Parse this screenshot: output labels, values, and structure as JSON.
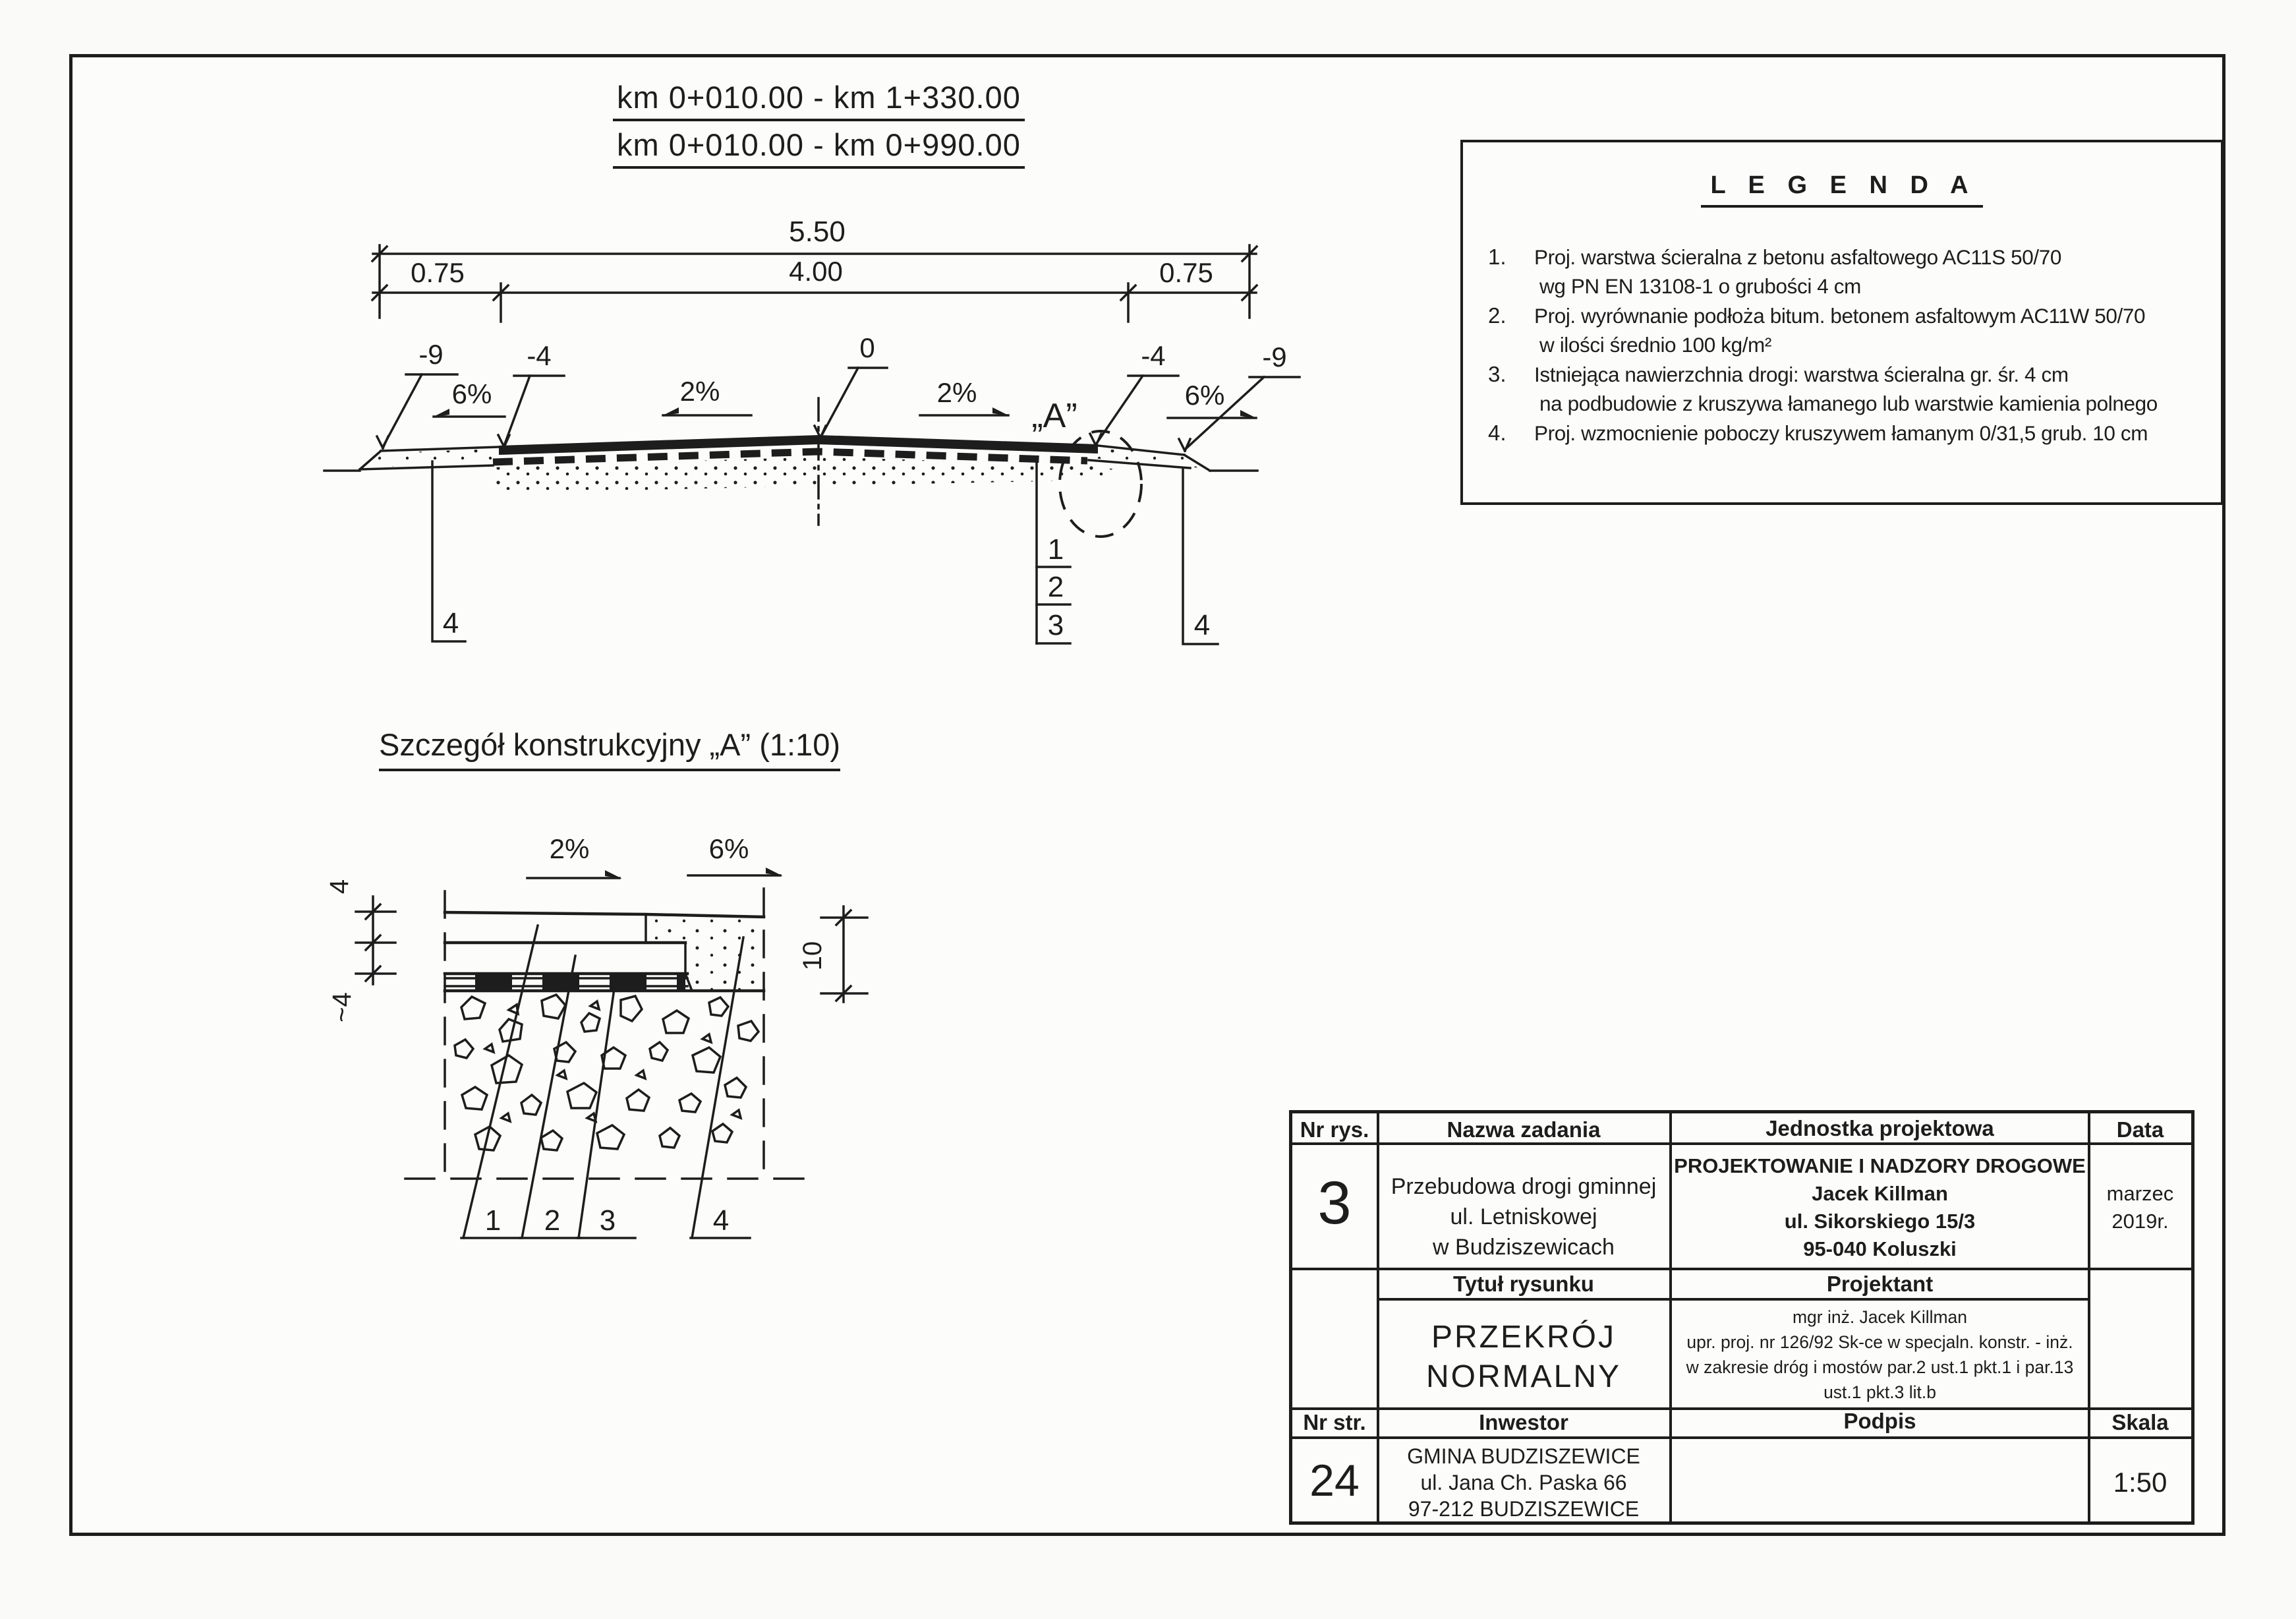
{
  "colors": {
    "ink": "#1d1d1d",
    "paper": "#fcfcfa"
  },
  "header": {
    "line1": "km 0+010.00 - km 1+330.00",
    "line2": "km 0+010.00 - km 0+990.00"
  },
  "legend": {
    "title": "L E G E N D A",
    "items": [
      {
        "num": "1.",
        "line1": "Proj. warstwa ścieralna z betonu asfaltowego AC11S 50/70",
        "line2": "wg PN EN 13108-1 o grubości 4 cm"
      },
      {
        "num": "2.",
        "line1": "Proj. wyrównanie podłoża bitum. betonem asfaltowym AC11W 50/70",
        "line2": "w ilości średnio 100 kg/m²"
      },
      {
        "num": "3.",
        "line1": "Istniejąca nawierzchnia drogi: warstwa ścieralna gr. śr. 4 cm",
        "line2": "na podbudowie z kruszywa łamanego lub warstwie kamienia polnego"
      },
      {
        "num": "4.",
        "line1": "Proj. wzmocnienie poboczy kruszywem łamanym 0/31,5 grub. 10 cm",
        "line2": ""
      }
    ]
  },
  "section": {
    "dim_total": "5.50",
    "dim_left": "0.75",
    "dim_mid": "4.00",
    "dim_right": "0.75",
    "elev_l9": "-9",
    "elev_l4": "-4",
    "elev_0": "0",
    "elev_r4": "-4",
    "elev_r9": "-9",
    "slope_l6": "6%",
    "slope_l2": "2%",
    "slope_r2": "2%",
    "slope_r6": "6%",
    "detail_mark": "„A”",
    "call_left4": "4",
    "call_1": "1",
    "call_2": "2",
    "call_3": "3",
    "call_right4": "4"
  },
  "detail": {
    "title": "Szczegół konstrukcyjny „A” (1:10)",
    "slope_2": "2%",
    "slope_6": "6%",
    "dim_4": "4",
    "dim_about4": "~4",
    "dim_10": "10",
    "call_1": "1",
    "call_2": "2",
    "call_3": "3",
    "call_4": "4"
  },
  "titleblock": {
    "h_nr_rys": "Nr rys.",
    "h_nazwa": "Nazwa zadania",
    "h_jednostka": "Jednostka projektowa",
    "h_data": "Data",
    "nr_rys": "3",
    "nazwa1": "Przebudowa drogi gminnej",
    "nazwa2": "ul. Letniskowej",
    "nazwa3": "w Budziszewicach",
    "jedn1": "PROJEKTOWANIE I NADZORY DROGOWE",
    "jedn2": "Jacek Killman",
    "jedn3": "ul. Sikorskiego 15/3",
    "jedn4": "95-040 Koluszki",
    "data1": "marzec",
    "data2": "2019r.",
    "h_tytul": "Tytuł rysunku",
    "h_projektant": "Projektant",
    "tytul1": "PRZEKRÓJ",
    "tytul2": "NORMALNY",
    "proj1": "mgr inż. Jacek Killman",
    "proj2": "upr. proj. nr 126/92 Sk-ce w specjaln. konstr. - inż.",
    "proj3": "w zakresie dróg i mostów par.2 ust.1 pkt.1 i par.13",
    "proj4": "ust.1 pkt.3 lit.b",
    "h_nr_str": "Nr str.",
    "h_inwestor": "Inwestor",
    "h_podpis": "Podpis",
    "h_skala": "Skala",
    "nr_str": "24",
    "inw1": "GMINA BUDZISZEWICE",
    "inw2": "ul. Jana Ch. Paska 66",
    "inw3": "97-212 BUDZISZEWICE",
    "skala": "1:50"
  }
}
